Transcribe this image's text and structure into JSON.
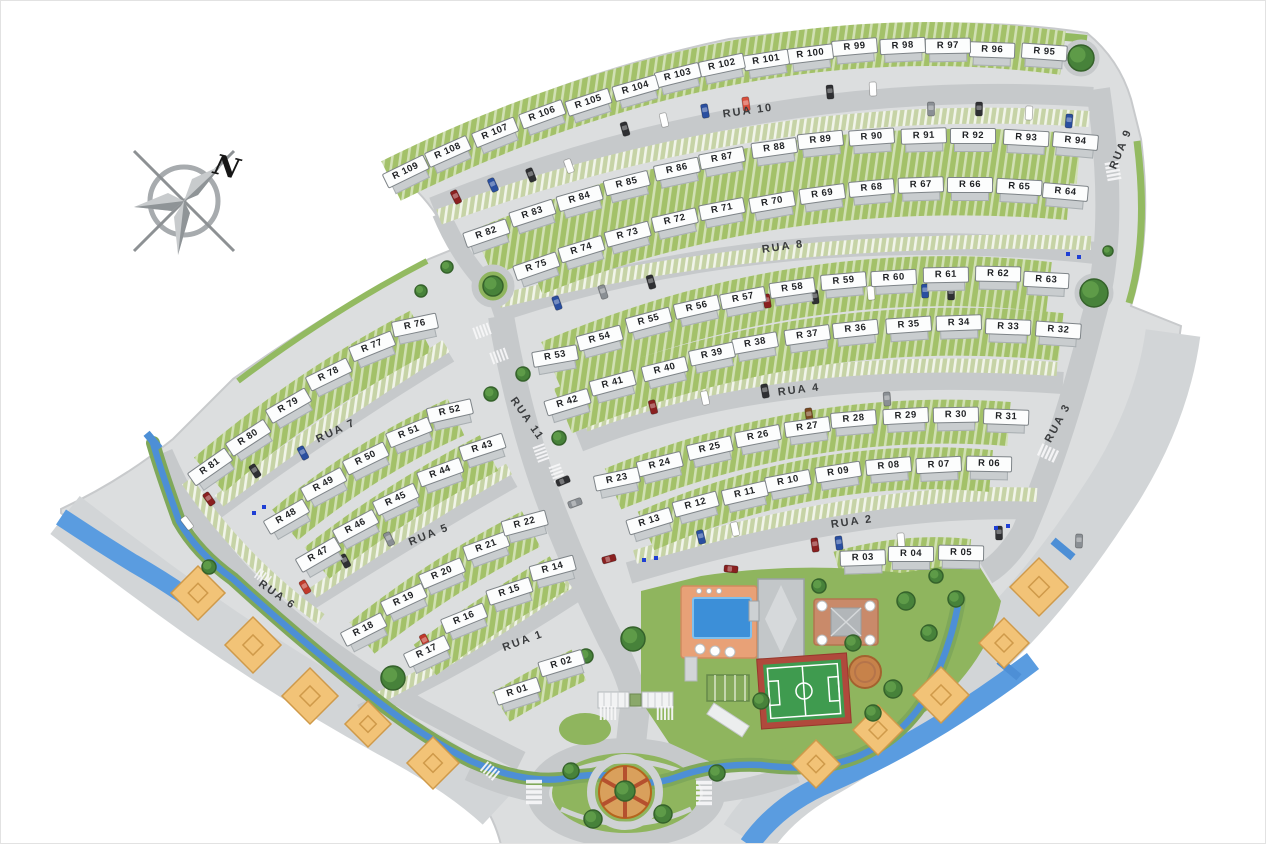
{
  "compass": {
    "label": "N"
  },
  "palette": {
    "site_gray": "#dcdedf",
    "apron_gray": "#d2d5d7",
    "road_gray": "#c6c9cb",
    "garden_green": "#a3c169",
    "lawn_green": "#8fb55e",
    "parking_green": "#c6d3a6",
    "water_blue": "#4d8fd6",
    "river_blue": "#5a9ce0",
    "deck_orange": "#e8a177",
    "pool_blue": "#3c8fd8",
    "diamond_orange": "#f2c377",
    "court_green": "#3f9b4f",
    "court_red": "#b0493c",
    "chip_white": "#fcfdfd",
    "marker_blue": "#1f3fd4"
  },
  "streets": [
    {
      "name": "RUA 1",
      "x": 522,
      "y": 640,
      "rot": -20
    },
    {
      "name": "RUA 2",
      "x": 851,
      "y": 521,
      "rot": -8
    },
    {
      "name": "RUA 3",
      "x": 1057,
      "y": 422,
      "rot": -62
    },
    {
      "name": "RUA 4",
      "x": 798,
      "y": 389,
      "rot": -7
    },
    {
      "name": "RUA 5",
      "x": 428,
      "y": 534,
      "rot": -22
    },
    {
      "name": "RUA 6",
      "x": 276,
      "y": 594,
      "rot": 35
    },
    {
      "name": "RUA 7",
      "x": 335,
      "y": 430,
      "rot": -25
    },
    {
      "name": "RUA 8",
      "x": 782,
      "y": 246,
      "rot": -8
    },
    {
      "name": "RUA 9",
      "x": 1120,
      "y": 148,
      "rot": -68
    },
    {
      "name": "RUA 10",
      "x": 747,
      "y": 110,
      "rot": -8
    },
    {
      "name": "RUA 11",
      "x": 526,
      "y": 418,
      "rot": 55
    }
  ],
  "lots": [
    {
      "label": "R 01",
      "x": 518,
      "y": 695,
      "rot": -18
    },
    {
      "label": "R 02",
      "x": 562,
      "y": 667,
      "rot": -17
    },
    {
      "label": "R 03",
      "x": 862,
      "y": 562,
      "rot": -2
    },
    {
      "label": "R 04",
      "x": 910,
      "y": 558,
      "rot": 0
    },
    {
      "label": "R 05",
      "x": 960,
      "y": 557,
      "rot": 1
    },
    {
      "label": "R 06",
      "x": 988,
      "y": 468,
      "rot": 1
    },
    {
      "label": "R 07",
      "x": 938,
      "y": 469,
      "rot": -3
    },
    {
      "label": "R 08",
      "x": 888,
      "y": 470,
      "rot": -5
    },
    {
      "label": "R 09",
      "x": 838,
      "y": 476,
      "rot": -9
    },
    {
      "label": "R 10",
      "x": 788,
      "y": 485,
      "rot": -11
    },
    {
      "label": "R 11",
      "x": 745,
      "y": 497,
      "rot": -13
    },
    {
      "label": "R 12",
      "x": 696,
      "y": 508,
      "rot": -15
    },
    {
      "label": "R 13",
      "x": 650,
      "y": 525,
      "rot": -17
    },
    {
      "label": "R 14",
      "x": 553,
      "y": 572,
      "rot": -15
    },
    {
      "label": "R 15",
      "x": 510,
      "y": 595,
      "rot": -18
    },
    {
      "label": "R 16",
      "x": 465,
      "y": 622,
      "rot": -22
    },
    {
      "label": "R 17",
      "x": 428,
      "y": 655,
      "rot": -25
    },
    {
      "label": "R 18",
      "x": 365,
      "y": 633,
      "rot": -27
    },
    {
      "label": "R 19",
      "x": 405,
      "y": 603,
      "rot": -25
    },
    {
      "label": "R 20",
      "x": 443,
      "y": 577,
      "rot": -23
    },
    {
      "label": "R 21",
      "x": 487,
      "y": 550,
      "rot": -20
    },
    {
      "label": "R 22",
      "x": 525,
      "y": 527,
      "rot": -15
    },
    {
      "label": "R 23",
      "x": 617,
      "y": 483,
      "rot": -12
    },
    {
      "label": "R 24",
      "x": 660,
      "y": 468,
      "rot": -14
    },
    {
      "label": "R 25",
      "x": 710,
      "y": 452,
      "rot": -13
    },
    {
      "label": "R 26",
      "x": 758,
      "y": 440,
      "rot": -11
    },
    {
      "label": "R 27",
      "x": 807,
      "y": 431,
      "rot": -8
    },
    {
      "label": "R 28",
      "x": 853,
      "y": 423,
      "rot": -5
    },
    {
      "label": "R 29",
      "x": 905,
      "y": 420,
      "rot": -3
    },
    {
      "label": "R 30",
      "x": 955,
      "y": 419,
      "rot": -1
    },
    {
      "label": "R 31",
      "x": 1005,
      "y": 421,
      "rot": 2
    },
    {
      "label": "R 32",
      "x": 1057,
      "y": 334,
      "rot": 4
    },
    {
      "label": "R 33",
      "x": 1007,
      "y": 331,
      "rot": 2
    },
    {
      "label": "R 34",
      "x": 958,
      "y": 327,
      "rot": -2
    },
    {
      "label": "R 35",
      "x": 908,
      "y": 329,
      "rot": -4
    },
    {
      "label": "R 36",
      "x": 855,
      "y": 333,
      "rot": -6
    },
    {
      "label": "R 37",
      "x": 807,
      "y": 339,
      "rot": -8
    },
    {
      "label": "R 38",
      "x": 755,
      "y": 347,
      "rot": -10
    },
    {
      "label": "R 39",
      "x": 712,
      "y": 358,
      "rot": -12
    },
    {
      "label": "R 40",
      "x": 665,
      "y": 373,
      "rot": -14
    },
    {
      "label": "R 41",
      "x": 613,
      "y": 387,
      "rot": -15
    },
    {
      "label": "R 42",
      "x": 568,
      "y": 406,
      "rot": -17
    },
    {
      "label": "R 43",
      "x": 483,
      "y": 451,
      "rot": -18
    },
    {
      "label": "R 44",
      "x": 441,
      "y": 476,
      "rot": -20
    },
    {
      "label": "R 45",
      "x": 397,
      "y": 503,
      "rot": -25
    },
    {
      "label": "R 46",
      "x": 357,
      "y": 530,
      "rot": -28
    },
    {
      "label": "R 47",
      "x": 320,
      "y": 558,
      "rot": -30
    },
    {
      "label": "R 48",
      "x": 288,
      "y": 520,
      "rot": -30
    },
    {
      "label": "R 49",
      "x": 325,
      "y": 488,
      "rot": -28
    },
    {
      "label": "R 50",
      "x": 367,
      "y": 462,
      "rot": -26
    },
    {
      "label": "R 51",
      "x": 410,
      "y": 436,
      "rot": -22
    },
    {
      "label": "R 52",
      "x": 450,
      "y": 415,
      "rot": -13
    },
    {
      "label": "R 53",
      "x": 555,
      "y": 360,
      "rot": -10
    },
    {
      "label": "R 54",
      "x": 600,
      "y": 342,
      "rot": -15
    },
    {
      "label": "R 55",
      "x": 649,
      "y": 324,
      "rot": -15
    },
    {
      "label": "R 56",
      "x": 697,
      "y": 311,
      "rot": -13
    },
    {
      "label": "R 57",
      "x": 743,
      "y": 302,
      "rot": -11
    },
    {
      "label": "R 58",
      "x": 792,
      "y": 292,
      "rot": -8
    },
    {
      "label": "R 59",
      "x": 843,
      "y": 285,
      "rot": -5
    },
    {
      "label": "R 60",
      "x": 893,
      "y": 282,
      "rot": -3
    },
    {
      "label": "R 61",
      "x": 945,
      "y": 279,
      "rot": -1
    },
    {
      "label": "R 62",
      "x": 997,
      "y": 278,
      "rot": 1
    },
    {
      "label": "R 63",
      "x": 1045,
      "y": 284,
      "rot": 3
    },
    {
      "label": "R 64",
      "x": 1064,
      "y": 196,
      "rot": 5
    },
    {
      "label": "R 65",
      "x": 1018,
      "y": 191,
      "rot": 3
    },
    {
      "label": "R 66",
      "x": 969,
      "y": 189,
      "rot": 0
    },
    {
      "label": "R 67",
      "x": 920,
      "y": 189,
      "rot": -2
    },
    {
      "label": "R 68",
      "x": 871,
      "y": 192,
      "rot": -5
    },
    {
      "label": "R 69",
      "x": 822,
      "y": 198,
      "rot": -8
    },
    {
      "label": "R 70",
      "x": 772,
      "y": 206,
      "rot": -10
    },
    {
      "label": "R 71",
      "x": 722,
      "y": 213,
      "rot": -11
    },
    {
      "label": "R 72",
      "x": 675,
      "y": 224,
      "rot": -13
    },
    {
      "label": "R 73",
      "x": 628,
      "y": 238,
      "rot": -15
    },
    {
      "label": "R 74",
      "x": 582,
      "y": 253,
      "rot": -17
    },
    {
      "label": "R 75",
      "x": 537,
      "y": 270,
      "rot": -19
    },
    {
      "label": "R 76",
      "x": 415,
      "y": 329,
      "rot": -12
    },
    {
      "label": "R 77",
      "x": 373,
      "y": 350,
      "rot": -22
    },
    {
      "label": "R 78",
      "x": 330,
      "y": 378,
      "rot": -26
    },
    {
      "label": "R 79",
      "x": 290,
      "y": 409,
      "rot": -30
    },
    {
      "label": "R 80",
      "x": 250,
      "y": 441,
      "rot": -33
    },
    {
      "label": "R 81",
      "x": 212,
      "y": 470,
      "rot": -35
    },
    {
      "label": "R 82",
      "x": 487,
      "y": 237,
      "rot": -19
    },
    {
      "label": "R 83",
      "x": 533,
      "y": 217,
      "rot": -18
    },
    {
      "label": "R 84",
      "x": 580,
      "y": 202,
      "rot": -16
    },
    {
      "label": "R 85",
      "x": 627,
      "y": 187,
      "rot": -14
    },
    {
      "label": "R 86",
      "x": 677,
      "y": 173,
      "rot": -12
    },
    {
      "label": "R 87",
      "x": 722,
      "y": 162,
      "rot": -11
    },
    {
      "label": "R 88",
      "x": 774,
      "y": 152,
      "rot": -8
    },
    {
      "label": "R 89",
      "x": 820,
      "y": 144,
      "rot": -6
    },
    {
      "label": "R 90",
      "x": 871,
      "y": 141,
      "rot": -4
    },
    {
      "label": "R 91",
      "x": 923,
      "y": 140,
      "rot": -2
    },
    {
      "label": "R 92",
      "x": 972,
      "y": 140,
      "rot": 0
    },
    {
      "label": "R 93",
      "x": 1025,
      "y": 142,
      "rot": 3
    },
    {
      "label": "R 94",
      "x": 1074,
      "y": 145,
      "rot": 5
    },
    {
      "label": "R 95",
      "x": 1043,
      "y": 56,
      "rot": 4
    },
    {
      "label": "R 96",
      "x": 991,
      "y": 54,
      "rot": 2
    },
    {
      "label": "R 97",
      "x": 947,
      "y": 50,
      "rot": -1
    },
    {
      "label": "R 98",
      "x": 902,
      "y": 50,
      "rot": -3
    },
    {
      "label": "R 99",
      "x": 854,
      "y": 51,
      "rot": -5
    },
    {
      "label": "R 100",
      "x": 810,
      "y": 58,
      "rot": -7
    },
    {
      "label": "R 101",
      "x": 766,
      "y": 64,
      "rot": -9
    },
    {
      "label": "R 102",
      "x": 722,
      "y": 69,
      "rot": -12
    },
    {
      "label": "R 103",
      "x": 678,
      "y": 79,
      "rot": -14
    },
    {
      "label": "R 104",
      "x": 636,
      "y": 92,
      "rot": -16
    },
    {
      "label": "R 105",
      "x": 589,
      "y": 106,
      "rot": -18
    },
    {
      "label": "R 106",
      "x": 543,
      "y": 118,
      "rot": -20
    },
    {
      "label": "R 107",
      "x": 496,
      "y": 136,
      "rot": -22
    },
    {
      "label": "R 108",
      "x": 449,
      "y": 155,
      "rot": -24
    },
    {
      "label": "R 109",
      "x": 407,
      "y": 175,
      "rot": -26
    }
  ],
  "markers": {
    "cars": [
      {
        "x": 455,
        "y": 196,
        "rot": 64,
        "c": "#8a2020"
      },
      {
        "x": 492,
        "y": 184,
        "rot": 66,
        "c": "#2a4fa0"
      },
      {
        "x": 530,
        "y": 174,
        "rot": 68,
        "c": "#2f3033"
      },
      {
        "x": 568,
        "y": 165,
        "rot": 70,
        "c": "#ffffff"
      },
      {
        "x": 624,
        "y": 128,
        "rot": 74,
        "c": "#2f3033"
      },
      {
        "x": 663,
        "y": 119,
        "rot": 77,
        "c": "#ffffff"
      },
      {
        "x": 704,
        "y": 110,
        "rot": 80,
        "c": "#2a4fa0"
      },
      {
        "x": 745,
        "y": 103,
        "rot": 82,
        "c": "#d94f3d"
      },
      {
        "x": 829,
        "y": 91,
        "rot": 85,
        "c": "#2f3033"
      },
      {
        "x": 872,
        "y": 88,
        "rot": 87,
        "c": "#ffffff"
      },
      {
        "x": 930,
        "y": 108,
        "rot": 89,
        "c": "#8a8f94"
      },
      {
        "x": 978,
        "y": 108,
        "rot": 91,
        "c": "#2f3033"
      },
      {
        "x": 1028,
        "y": 112,
        "rot": 93,
        "c": "#ffffff"
      },
      {
        "x": 1068,
        "y": 120,
        "rot": 95,
        "c": "#2a4fa0"
      },
      {
        "x": 556,
        "y": 302,
        "rot": 70,
        "c": "#2a4fa0"
      },
      {
        "x": 602,
        "y": 291,
        "rot": 72,
        "c": "#8a8f94"
      },
      {
        "x": 650,
        "y": 281,
        "rot": 74,
        "c": "#2f3033"
      },
      {
        "x": 766,
        "y": 300,
        "rot": 81,
        "c": "#8a2020"
      },
      {
        "x": 814,
        "y": 296,
        "rot": 83,
        "c": "#2f3033"
      },
      {
        "x": 870,
        "y": 292,
        "rot": 85,
        "c": "#ffffff"
      },
      {
        "x": 924,
        "y": 290,
        "rot": 88,
        "c": "#2a4fa0"
      },
      {
        "x": 950,
        "y": 292,
        "rot": 89,
        "c": "#2f3033"
      },
      {
        "x": 652,
        "y": 406,
        "rot": 76,
        "c": "#8a2020"
      },
      {
        "x": 704,
        "y": 397,
        "rot": 78,
        "c": "#ffffff"
      },
      {
        "x": 764,
        "y": 390,
        "rot": 80,
        "c": "#2f3033"
      },
      {
        "x": 886,
        "y": 398,
        "rot": 86,
        "c": "#8a8f94"
      },
      {
        "x": 808,
        "y": 414,
        "rot": 82,
        "c": "#7a4a21"
      },
      {
        "x": 700,
        "y": 536,
        "rot": 76,
        "c": "#2a4fa0"
      },
      {
        "x": 734,
        "y": 528,
        "rot": 78,
        "c": "#ffffff"
      },
      {
        "x": 814,
        "y": 544,
        "rot": 82,
        "c": "#8a2020"
      },
      {
        "x": 838,
        "y": 542,
        "rot": 83,
        "c": "#2a4fa0"
      },
      {
        "x": 900,
        "y": 539,
        "rot": 85,
        "c": "#ffffff"
      },
      {
        "x": 998,
        "y": 532,
        "rot": 89,
        "c": "#2f3033"
      },
      {
        "x": 1078,
        "y": 540,
        "rot": 92,
        "c": "#8a8f94"
      },
      {
        "x": 208,
        "y": 498,
        "rot": 55,
        "c": "#8a2020"
      },
      {
        "x": 254,
        "y": 470,
        "rot": 58,
        "c": "#2f3033"
      },
      {
        "x": 302,
        "y": 452,
        "rot": 62,
        "c": "#2a4fa0"
      },
      {
        "x": 304,
        "y": 586,
        "rot": 60,
        "c": "#c0392b"
      },
      {
        "x": 344,
        "y": 560,
        "rot": 62,
        "c": "#2f3033"
      },
      {
        "x": 388,
        "y": 538,
        "rot": 64,
        "c": "#8a8f94"
      },
      {
        "x": 424,
        "y": 640,
        "rot": 63,
        "c": "#c0392b"
      },
      {
        "x": 454,
        "y": 630,
        "rot": 65,
        "c": "#2f3033"
      },
      {
        "x": 562,
        "y": 480,
        "rot": -22,
        "c": "#2f3033"
      },
      {
        "x": 574,
        "y": 502,
        "rot": -20,
        "c": "#8a8f94"
      },
      {
        "x": 608,
        "y": 558,
        "rot": -15,
        "c": "#8a2020"
      },
      {
        "x": 730,
        "y": 568,
        "rot": 5,
        "c": "#8a2020"
      },
      {
        "x": 186,
        "y": 522,
        "rot": 53,
        "c": "#ffffff"
      }
    ],
    "trees": [
      {
        "x": 1080,
        "y": 57,
        "r": 13
      },
      {
        "x": 1093,
        "y": 292,
        "r": 14
      },
      {
        "x": 492,
        "y": 285,
        "r": 10
      },
      {
        "x": 392,
        "y": 677,
        "r": 12
      },
      {
        "x": 522,
        "y": 373,
        "r": 7
      },
      {
        "x": 490,
        "y": 393,
        "r": 7
      },
      {
        "x": 558,
        "y": 437,
        "r": 7
      },
      {
        "x": 632,
        "y": 638,
        "r": 12
      },
      {
        "x": 570,
        "y": 770,
        "r": 8
      },
      {
        "x": 592,
        "y": 818,
        "r": 9
      },
      {
        "x": 662,
        "y": 813,
        "r": 9
      },
      {
        "x": 716,
        "y": 772,
        "r": 8
      },
      {
        "x": 905,
        "y": 600,
        "r": 9
      },
      {
        "x": 928,
        "y": 632,
        "r": 8
      },
      {
        "x": 852,
        "y": 642,
        "r": 8
      },
      {
        "x": 818,
        "y": 585,
        "r": 7
      },
      {
        "x": 892,
        "y": 688,
        "r": 9
      },
      {
        "x": 955,
        "y": 598,
        "r": 8
      },
      {
        "x": 872,
        "y": 712,
        "r": 8
      },
      {
        "x": 585,
        "y": 655,
        "r": 7
      },
      {
        "x": 760,
        "y": 700,
        "r": 8
      },
      {
        "x": 208,
        "y": 566,
        "r": 7
      },
      {
        "x": 624,
        "y": 790,
        "r": 10
      },
      {
        "x": 446,
        "y": 266,
        "r": 6
      },
      {
        "x": 420,
        "y": 290,
        "r": 6
      },
      {
        "x": 935,
        "y": 575,
        "r": 7
      },
      {
        "x": 1107,
        "y": 250,
        "r": 5
      }
    ],
    "diamonds": [
      {
        "x": 197,
        "y": 592,
        "s": 54
      },
      {
        "x": 252,
        "y": 644,
        "s": 56
      },
      {
        "x": 309,
        "y": 695,
        "s": 56
      },
      {
        "x": 367,
        "y": 723,
        "s": 46
      },
      {
        "x": 432,
        "y": 762,
        "s": 52
      },
      {
        "x": 1038,
        "y": 586,
        "s": 58
      },
      {
        "x": 1003,
        "y": 642,
        "s": 50
      },
      {
        "x": 940,
        "y": 694,
        "s": 56
      },
      {
        "x": 877,
        "y": 729,
        "s": 50
      },
      {
        "x": 815,
        "y": 763,
        "s": 48
      }
    ],
    "blue_dots": [
      {
        "x": 1067,
        "y": 253
      },
      {
        "x": 1078,
        "y": 256
      },
      {
        "x": 995,
        "y": 527
      },
      {
        "x": 1007,
        "y": 525
      },
      {
        "x": 643,
        "y": 559
      },
      {
        "x": 655,
        "y": 557
      },
      {
        "x": 253,
        "y": 512
      },
      {
        "x": 263,
        "y": 506
      }
    ]
  }
}
